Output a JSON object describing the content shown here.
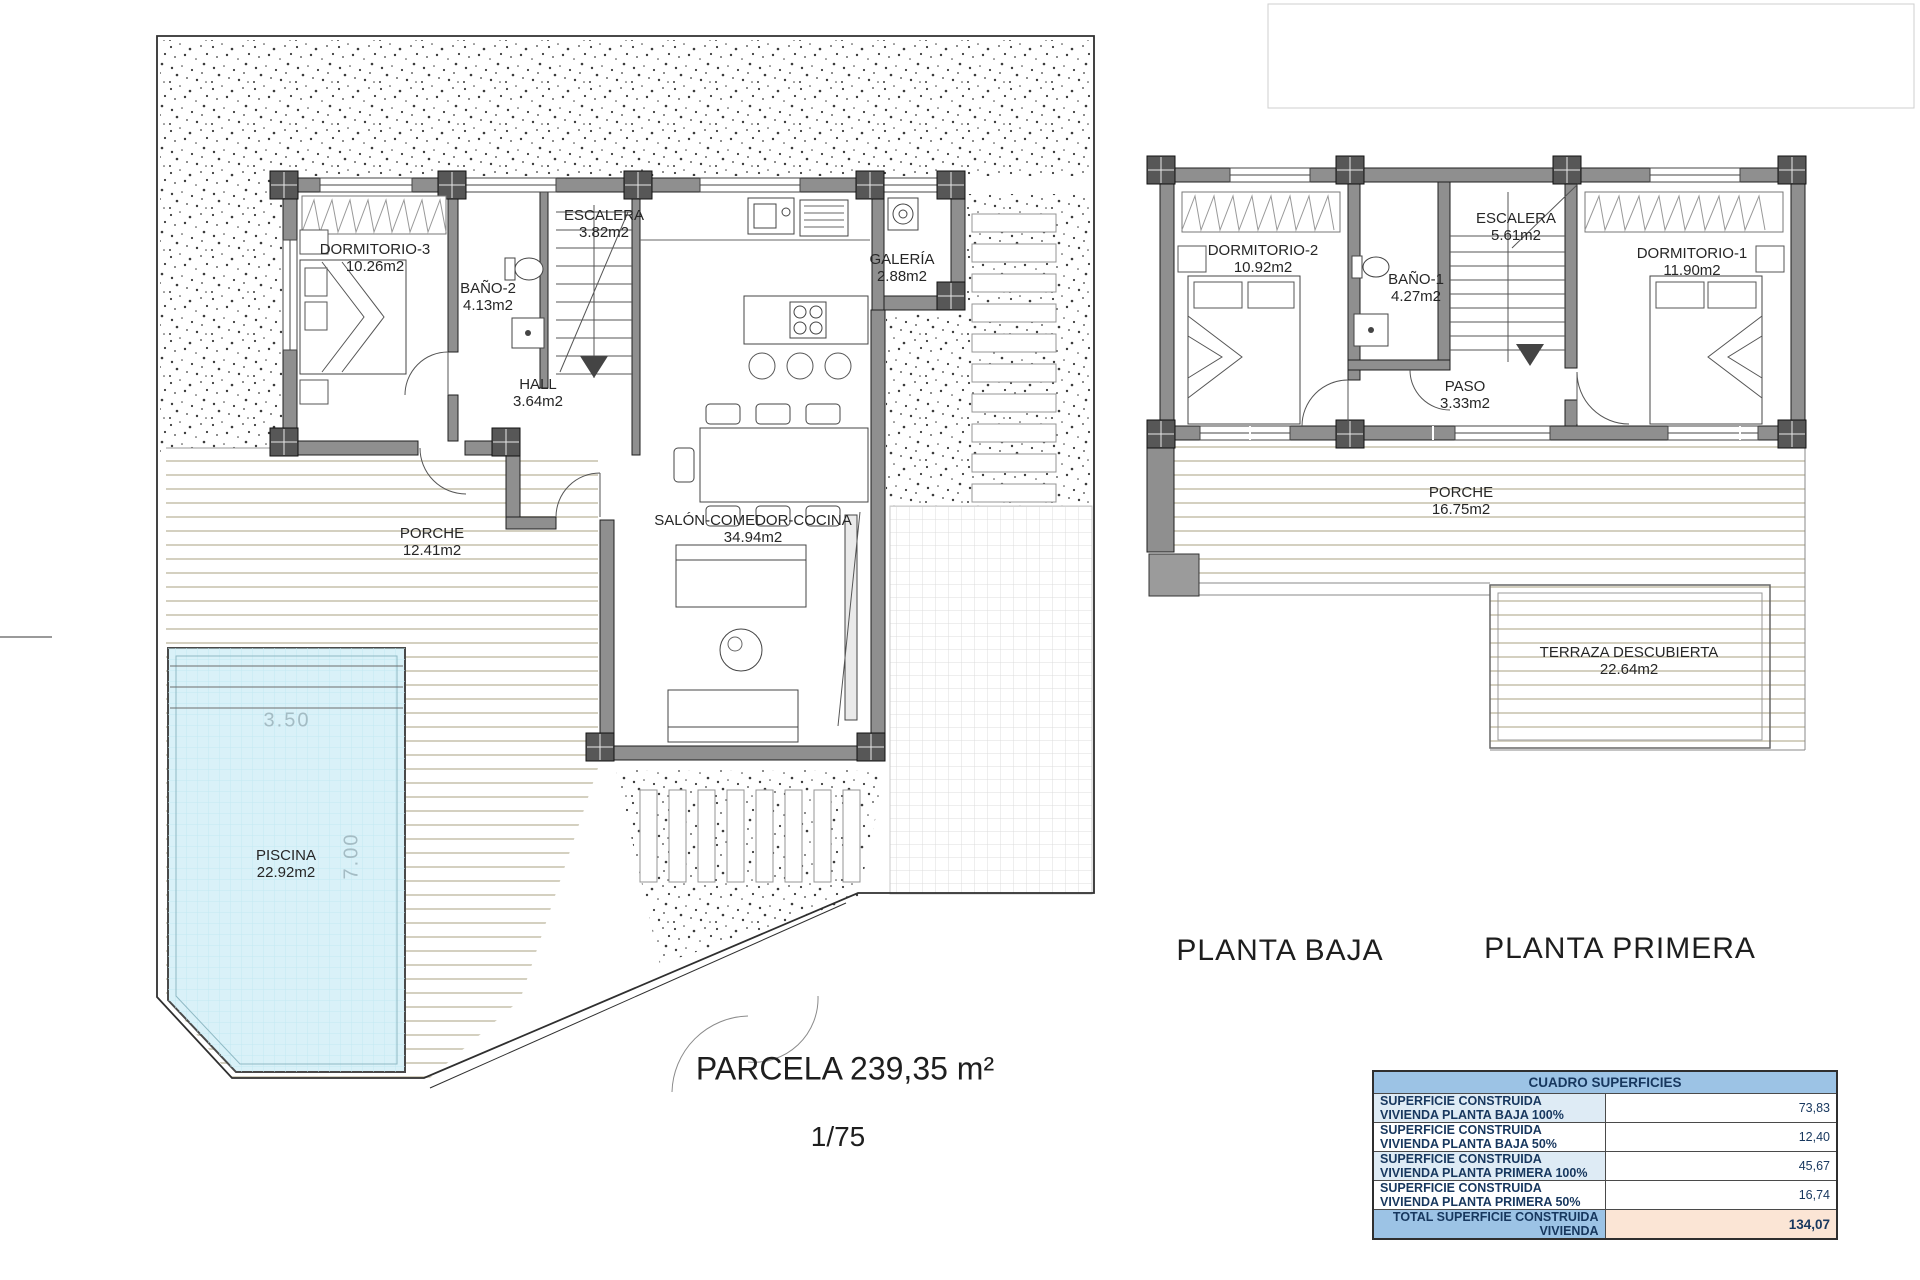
{
  "ground_floor": {
    "title": "PLANTA BAJA",
    "rooms": [
      {
        "name": "DORMITORIO-3",
        "area": "10.26m2"
      },
      {
        "name": "BAÑO-2",
        "area": "4.13m2"
      },
      {
        "name": "ESCALERA",
        "area": "3.82m2"
      },
      {
        "name": "GALERÍA",
        "area": "2.88m2"
      },
      {
        "name": "HALL",
        "area": "3.64m2"
      },
      {
        "name": "PORCHE",
        "area": "12.41m2"
      },
      {
        "name": "SALÓN-COMEDOR-COCINA",
        "area": "34.94m2"
      },
      {
        "name": "PISCINA",
        "area": "22.92m2"
      }
    ],
    "pool_dims": {
      "width": "3.50",
      "length": "7.00"
    },
    "parcel_label": "PARCELA 239,35 m²",
    "scale": "1/75"
  },
  "first_floor": {
    "title": "PLANTA PRIMERA",
    "rooms": [
      {
        "name": "DORMITORIO-2",
        "area": "10.92m2"
      },
      {
        "name": "BAÑO-1",
        "area": "4.27m2"
      },
      {
        "name": "ESCALERA",
        "area": "5.61m2"
      },
      {
        "name": "DORMITORIO-1",
        "area": "11.90m2"
      },
      {
        "name": "PASO",
        "area": "3.33m2"
      },
      {
        "name": "PORCHE",
        "area": "16.75m2"
      },
      {
        "name": "TERRAZA DESCUBIERTA",
        "area": "22.64m2"
      }
    ]
  },
  "surfaces_table": {
    "title": "CUADRO SUPERFICIES",
    "rows": [
      {
        "label": "SUPERFICIE CONSTRUIDA VIVIENDA PLANTA BAJA 100%",
        "value": "73,83"
      },
      {
        "label": "SUPERFICIE CONSTRUIDA VIVIENDA PLANTA BAJA 50%",
        "value": "12,40"
      },
      {
        "label": "SUPERFICIE CONSTRUIDA VIVIENDA PLANTA PRIMERA 100%",
        "value": "45,67"
      },
      {
        "label": "SUPERFICIE CONSTRUIDA VIVIENDA PLANTA PRIMERA 50%",
        "value": "16,74"
      }
    ],
    "total": {
      "label": "TOTAL SUPERFICIE CONSTRUIDA VIVIENDA",
      "value": "134,07"
    }
  },
  "colors": {
    "table_header_blue": "#9CC3E5",
    "table_row_blue": "#DEEBF5",
    "table_total_peach": "#FBE5D5",
    "table_text_navy": "#17375E",
    "pool_blue": "#D9F1F8",
    "wall_gray": "#8F8F8F",
    "deck_stripe": "#D4D0C0"
  }
}
